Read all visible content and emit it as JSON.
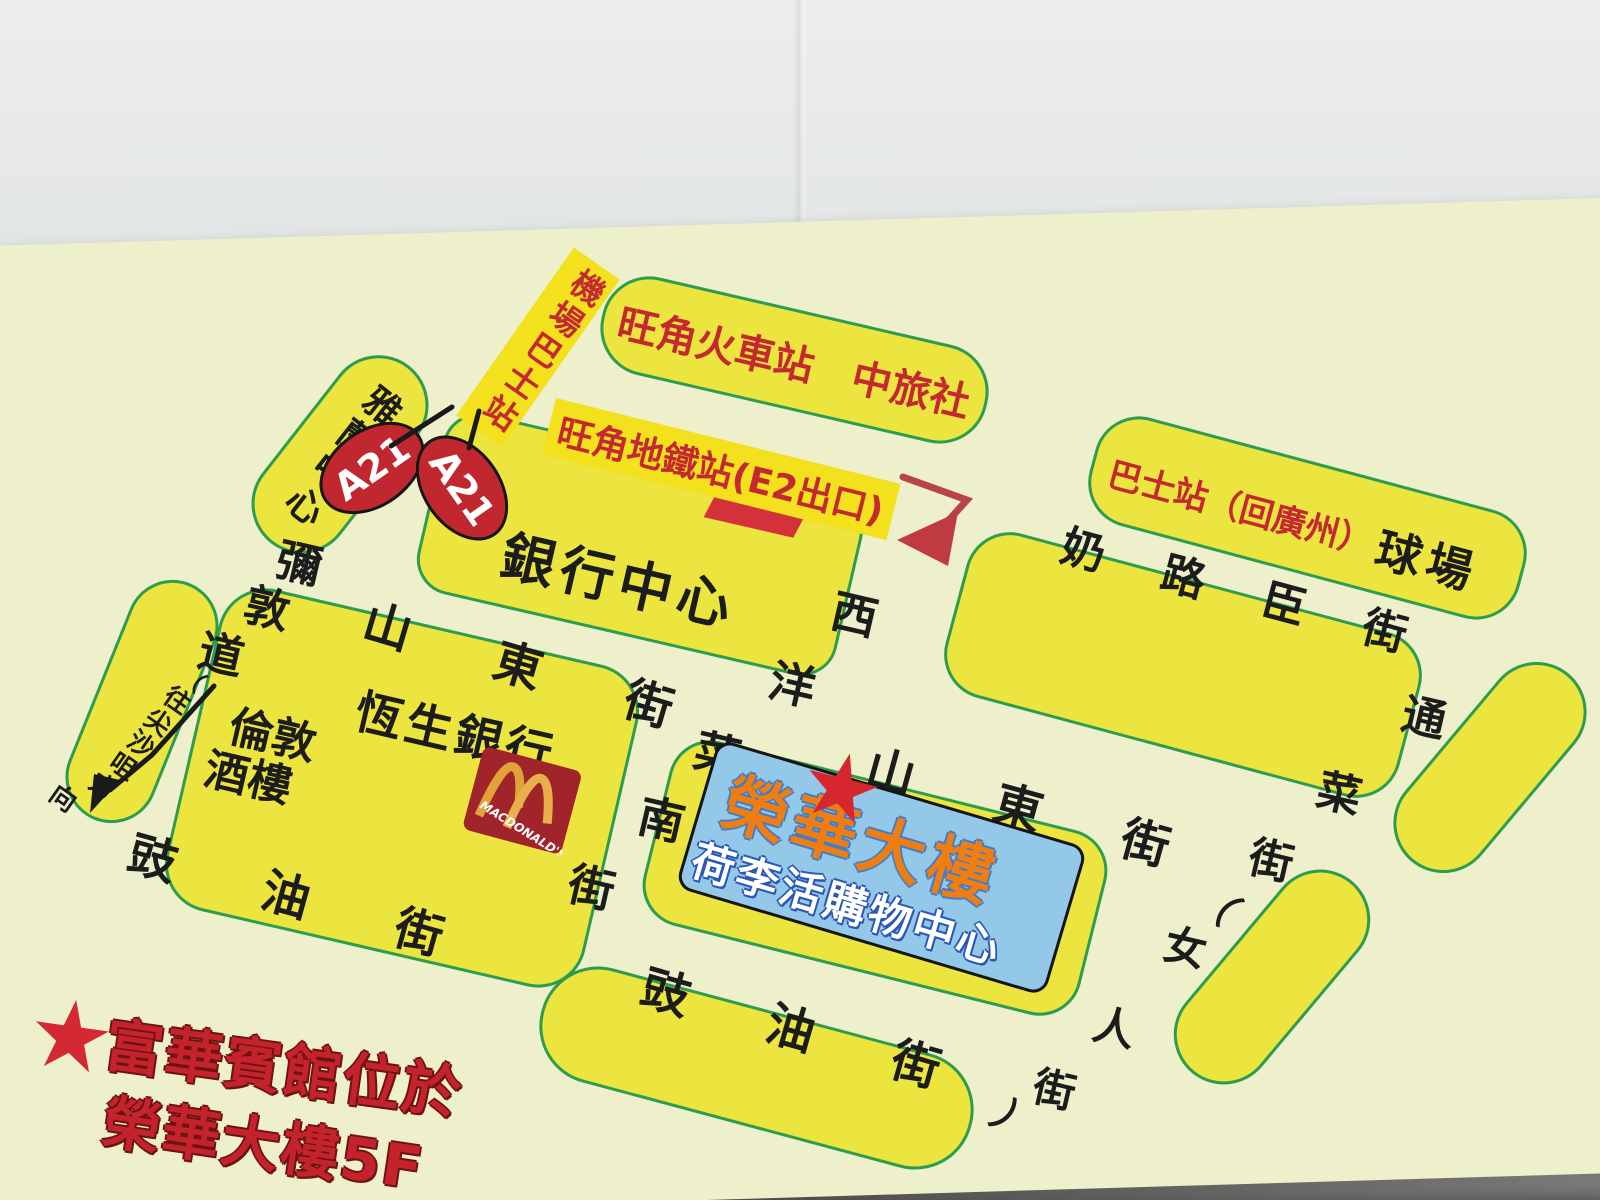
{
  "landmarks": {
    "yalan_centre": "雅蘭中心",
    "airport_bus_stop": "機場巴士站",
    "bus_route_a21": "A21",
    "mongkok_railway": "旺角火車站　中旅社",
    "mongkok_mtr_exit": "旺角地鐵站(E2出口)",
    "bank_centre": "銀行中心",
    "hangseng_bank": "恆生銀行",
    "london_restaurant_line1": "倫敦",
    "london_restaurant_line2": "酒樓",
    "mcdonalds_text": "MACDONALD'S",
    "wingwah_building": "榮華大樓",
    "hollywood_shopping_centre": "荷李活購物中心",
    "bus_stop_to_guangzhou": "巴士站（回廣州）",
    "sports_ground": "球場",
    "star": "★"
  },
  "streets": {
    "shantung": "山東街",
    "nelson": "奶路臣街",
    "soy": "豉油街",
    "sai_yeung_choi_south": "西洋菜南街",
    "tung_choi_ladies": "通菜街（女人街）",
    "nathan_road": "彌敦道",
    "nathan_note": "（往尖沙咀方向）"
  },
  "legend": {
    "star": "★",
    "line1": "富華賓館位於",
    "line2": "榮華大樓5F"
  },
  "colors": {
    "card_bg": "#edf0ca",
    "block_yellow": "#ece43f",
    "block_border_green": "#2e9c4e",
    "highlight_yellow": "#f3e11d",
    "text_red": "#c3292f",
    "text_black": "#1c1c1c",
    "a21_red": "#c0272e",
    "bluebox_bg": "#93c8e8",
    "wingwah_orange": "#ef7d12",
    "legend_red": "#c5232b",
    "mcdonalds_red": "#a1242b",
    "mcdonalds_gold": "#e2a23a"
  },
  "char_labels": [
    {
      "name": "street-sai-yeung-choi",
      "color": "#1c1c1c",
      "chars": [
        {
          "c": "西",
          "x": 855,
          "y": 612,
          "s": 46,
          "r": 13
        },
        {
          "c": "洋",
          "x": 793,
          "y": 682,
          "s": 46,
          "r": 13
        },
        {
          "c": "菜",
          "x": 718,
          "y": 752,
          "s": 46,
          "r": 13
        },
        {
          "c": "南",
          "x": 662,
          "y": 817,
          "s": 46,
          "r": 13
        },
        {
          "c": "街",
          "x": 592,
          "y": 885,
          "s": 46,
          "r": 13
        }
      ]
    },
    {
      "name": "street-tung-choi-ladies",
      "color": "#1c1c1c",
      "chars": [
        {
          "c": "通",
          "x": 1425,
          "y": 714,
          "s": 44,
          "r": 13
        },
        {
          "c": "菜",
          "x": 1340,
          "y": 790,
          "s": 44,
          "r": 13
        },
        {
          "c": "街",
          "x": 1272,
          "y": 857,
          "s": 44,
          "r": 13
        },
        {
          "c": "（",
          "x": 1220,
          "y": 900,
          "s": 40,
          "r": 45
        },
        {
          "c": "女",
          "x": 1186,
          "y": 945,
          "s": 42,
          "r": 13
        },
        {
          "c": "人",
          "x": 1115,
          "y": 1025,
          "s": 42,
          "r": 13
        },
        {
          "c": "街",
          "x": 1055,
          "y": 1087,
          "s": 42,
          "r": 13
        },
        {
          "c": "）",
          "x": 1015,
          "y": 1122,
          "s": 40,
          "r": 45
        }
      ]
    },
    {
      "name": "street-nathan-road",
      "color": "#1c1c1c",
      "chars": [
        {
          "c": "彌",
          "x": 300,
          "y": 560,
          "s": 45,
          "r": 13
        },
        {
          "c": "敦",
          "x": 268,
          "y": 605,
          "s": 45,
          "r": 13
        },
        {
          "c": "道",
          "x": 222,
          "y": 651,
          "s": 45,
          "r": 13
        }
      ]
    },
    {
      "name": "street-nathan-note",
      "color": "#1c1c1c",
      "chars": [
        {
          "c": "（",
          "x": 194,
          "y": 677,
          "s": 24,
          "r": 40
        },
        {
          "c": "往",
          "x": 178,
          "y": 699,
          "s": 26,
          "r": 35
        },
        {
          "c": "尖",
          "x": 159,
          "y": 721,
          "s": 26,
          "r": 35
        },
        {
          "c": "沙",
          "x": 142,
          "y": 743,
          "s": 26,
          "r": 35
        },
        {
          "c": "咀",
          "x": 124,
          "y": 765,
          "s": 26,
          "r": 35
        },
        {
          "c": "方",
          "x": 104,
          "y": 785,
          "s": 26,
          "r": 35
        },
        {
          "c": "向",
          "x": 64,
          "y": 797,
          "s": 26,
          "r": 35
        }
      ]
    }
  ]
}
